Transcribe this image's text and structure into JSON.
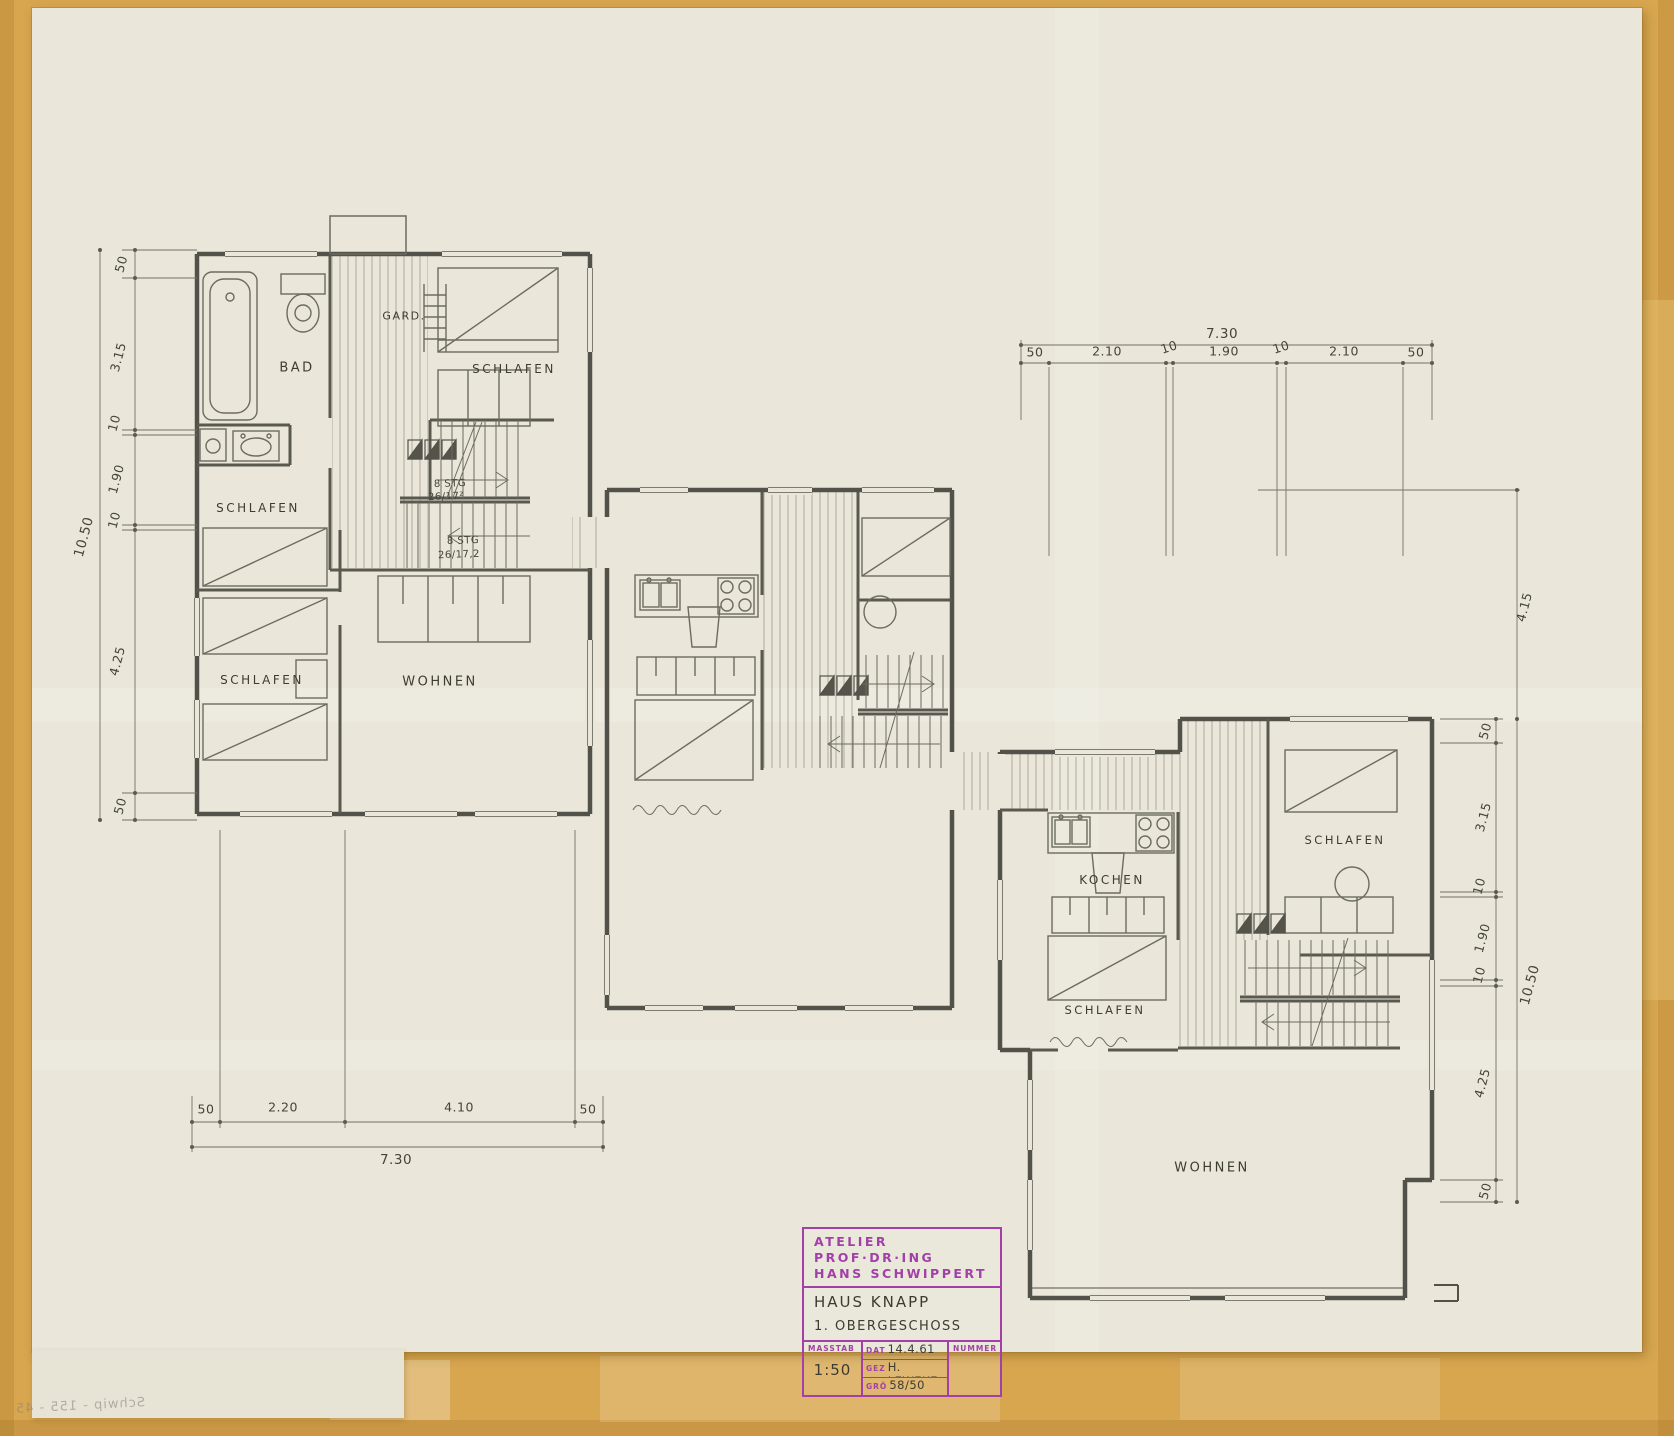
{
  "palette": {
    "mat": "#d7a64f",
    "paper": "#eae7da",
    "pencil": "#53524a",
    "stamp_purple": "#a23fa9"
  },
  "drawing": {
    "rooms": {
      "bad": "BAD",
      "gard": "GARD.",
      "schlafen_top_right": "SCHLAFEN",
      "schlafen_mid_left": "SCHLAFEN",
      "schlafen_bottom_left": "SCHLAFEN",
      "wohnen_left": "WOHNEN",
      "kochen": "KOCHEN",
      "schlafen_right_mid": "SCHLAFEN",
      "schlafen_right_top": "SCHLAFEN",
      "wohnen_right": "WOHNEN"
    },
    "stairs": {
      "flight1_line1": "8 STG",
      "flight1_line2": "26/17²",
      "flight2_line1": "8 STG",
      "flight2_line2": "26/17,2"
    },
    "dimensions": {
      "left": {
        "total": "10.50",
        "parts": [
          "50",
          "3.15",
          "10",
          "1.90",
          "10",
          "4.25",
          "50"
        ]
      },
      "bottom": {
        "total": "7.30",
        "parts": [
          "50",
          "2.20",
          "4.10",
          "50"
        ]
      },
      "top": {
        "total": "7.30",
        "parts": [
          "50",
          "2.10",
          "10",
          "1.90",
          "10",
          "2.10",
          "50"
        ]
      },
      "right": {
        "total": "10.50",
        "upper": "4.15",
        "parts": [
          "50",
          "3.15",
          "10",
          "1.90",
          "10",
          "4.25",
          "50"
        ]
      }
    },
    "title_block": {
      "atelier_line1": "ATELIER PROF·DR·ING",
      "atelier_line2": "HANS SCHWIPPERT",
      "project": "HAUS KNAPP",
      "sheet": "1. OBERGESCHOSS",
      "masstab_label": "MASSTAB",
      "masstab_value": "1:50",
      "dat_label": "DAT",
      "dat_value": "14.4.61",
      "gez_label": "GEZ",
      "gez_value": "H. LEWEKE",
      "gro_label": "GRÖ",
      "gro_value": "58/50",
      "nummer_label": "NUMMER"
    },
    "verso_note": "Schwip - 155 - 45"
  }
}
